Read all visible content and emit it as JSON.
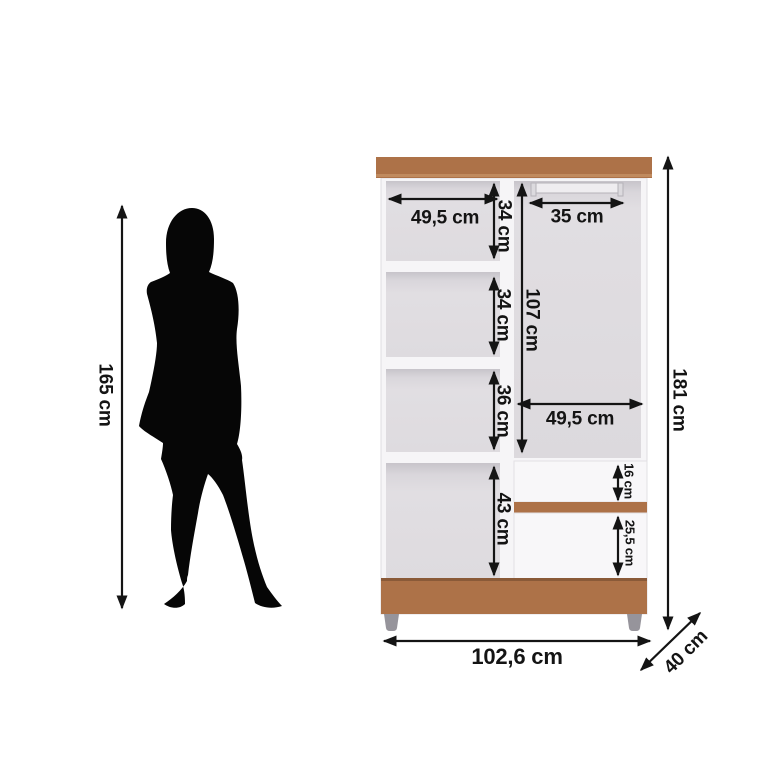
{
  "diagram": {
    "person": {
      "height": "165 cm"
    },
    "wardrobe": {
      "overall": {
        "height": "181 cm",
        "width": "102,6 cm",
        "depth": "40 cm"
      },
      "left_column": {
        "inner_width": "49,5 cm",
        "sections": [
          {
            "label": "34 cm"
          },
          {
            "label": "34 cm"
          },
          {
            "label": "36 cm"
          },
          {
            "label": "43 cm"
          }
        ]
      },
      "right_column": {
        "rod_width": "35 cm",
        "hanging_height": "107 cm",
        "inner_width": "49,5 cm",
        "top_drawer_height": "16 cm",
        "bottom_drawer_height": "25,5 cm"
      }
    },
    "colors": {
      "wood_brown": "#ad7248",
      "carcass_white": "#f6f5f7",
      "interior_gray": "#dedbdf",
      "dimension_black": "#141414",
      "feet_gray": "#96949b",
      "silhouette_black": "#060606"
    }
  }
}
